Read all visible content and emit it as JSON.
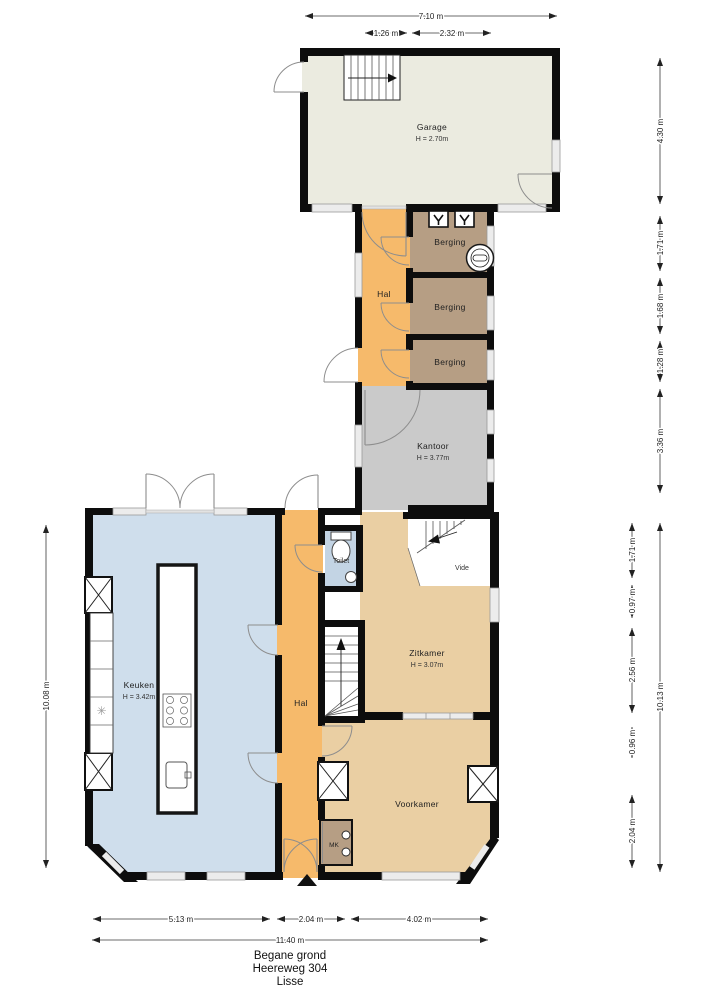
{
  "title": {
    "floor": "Begane grond",
    "street": "Heereweg 304",
    "city": "Lisse"
  },
  "rooms": {
    "garage": {
      "name": "Garage",
      "height": "H = 2.70m"
    },
    "hal_top": {
      "name": "Hal"
    },
    "berging_1": {
      "name": "Berging"
    },
    "berging_2": {
      "name": "Berging"
    },
    "berging_3": {
      "name": "Berging"
    },
    "kantoor": {
      "name": "Kantoor",
      "height": "H = 3.77m"
    },
    "keuken": {
      "name": "Keuken",
      "height": "H = 3.42m"
    },
    "hal_bottom": {
      "name": "Hal"
    },
    "toilet": {
      "name": "Toilet"
    },
    "vide": {
      "name": "Vide"
    },
    "zitkamer": {
      "name": "Zitkamer",
      "height": "H = 3.07m"
    },
    "voorkamer": {
      "name": "Voorkamer"
    },
    "meterkast": {
      "name": "MK"
    }
  },
  "dimensions": {
    "top": {
      "total": "7.10 m",
      "sub1": "1.26 m",
      "sub2": "2.32 m"
    },
    "right_upper": [
      "4.30 m",
      "1.71 m",
      "1.68 m",
      "1.28 m",
      "3.36 m"
    ],
    "right_lower": {
      "segments": [
        "1.71 m",
        "0.97 m",
        "2.56 m",
        "0.96 m",
        "2.04 m"
      ],
      "total": "10.13 m"
    },
    "left": {
      "total": "10.08 m"
    },
    "bottom": {
      "segments": [
        "5.13 m",
        "2.04 m",
        "4.02 m"
      ],
      "total": "11.40 m"
    }
  },
  "colors": {
    "wall": "#0d0d0d",
    "garage": "#ebebe0",
    "hal": "#f6ba6b",
    "berging": "#b69e84",
    "kantoor": "#cacaca",
    "keuken": "#cfdeec",
    "toilet": "#c3d4e4",
    "living": "#eacfa3"
  }
}
